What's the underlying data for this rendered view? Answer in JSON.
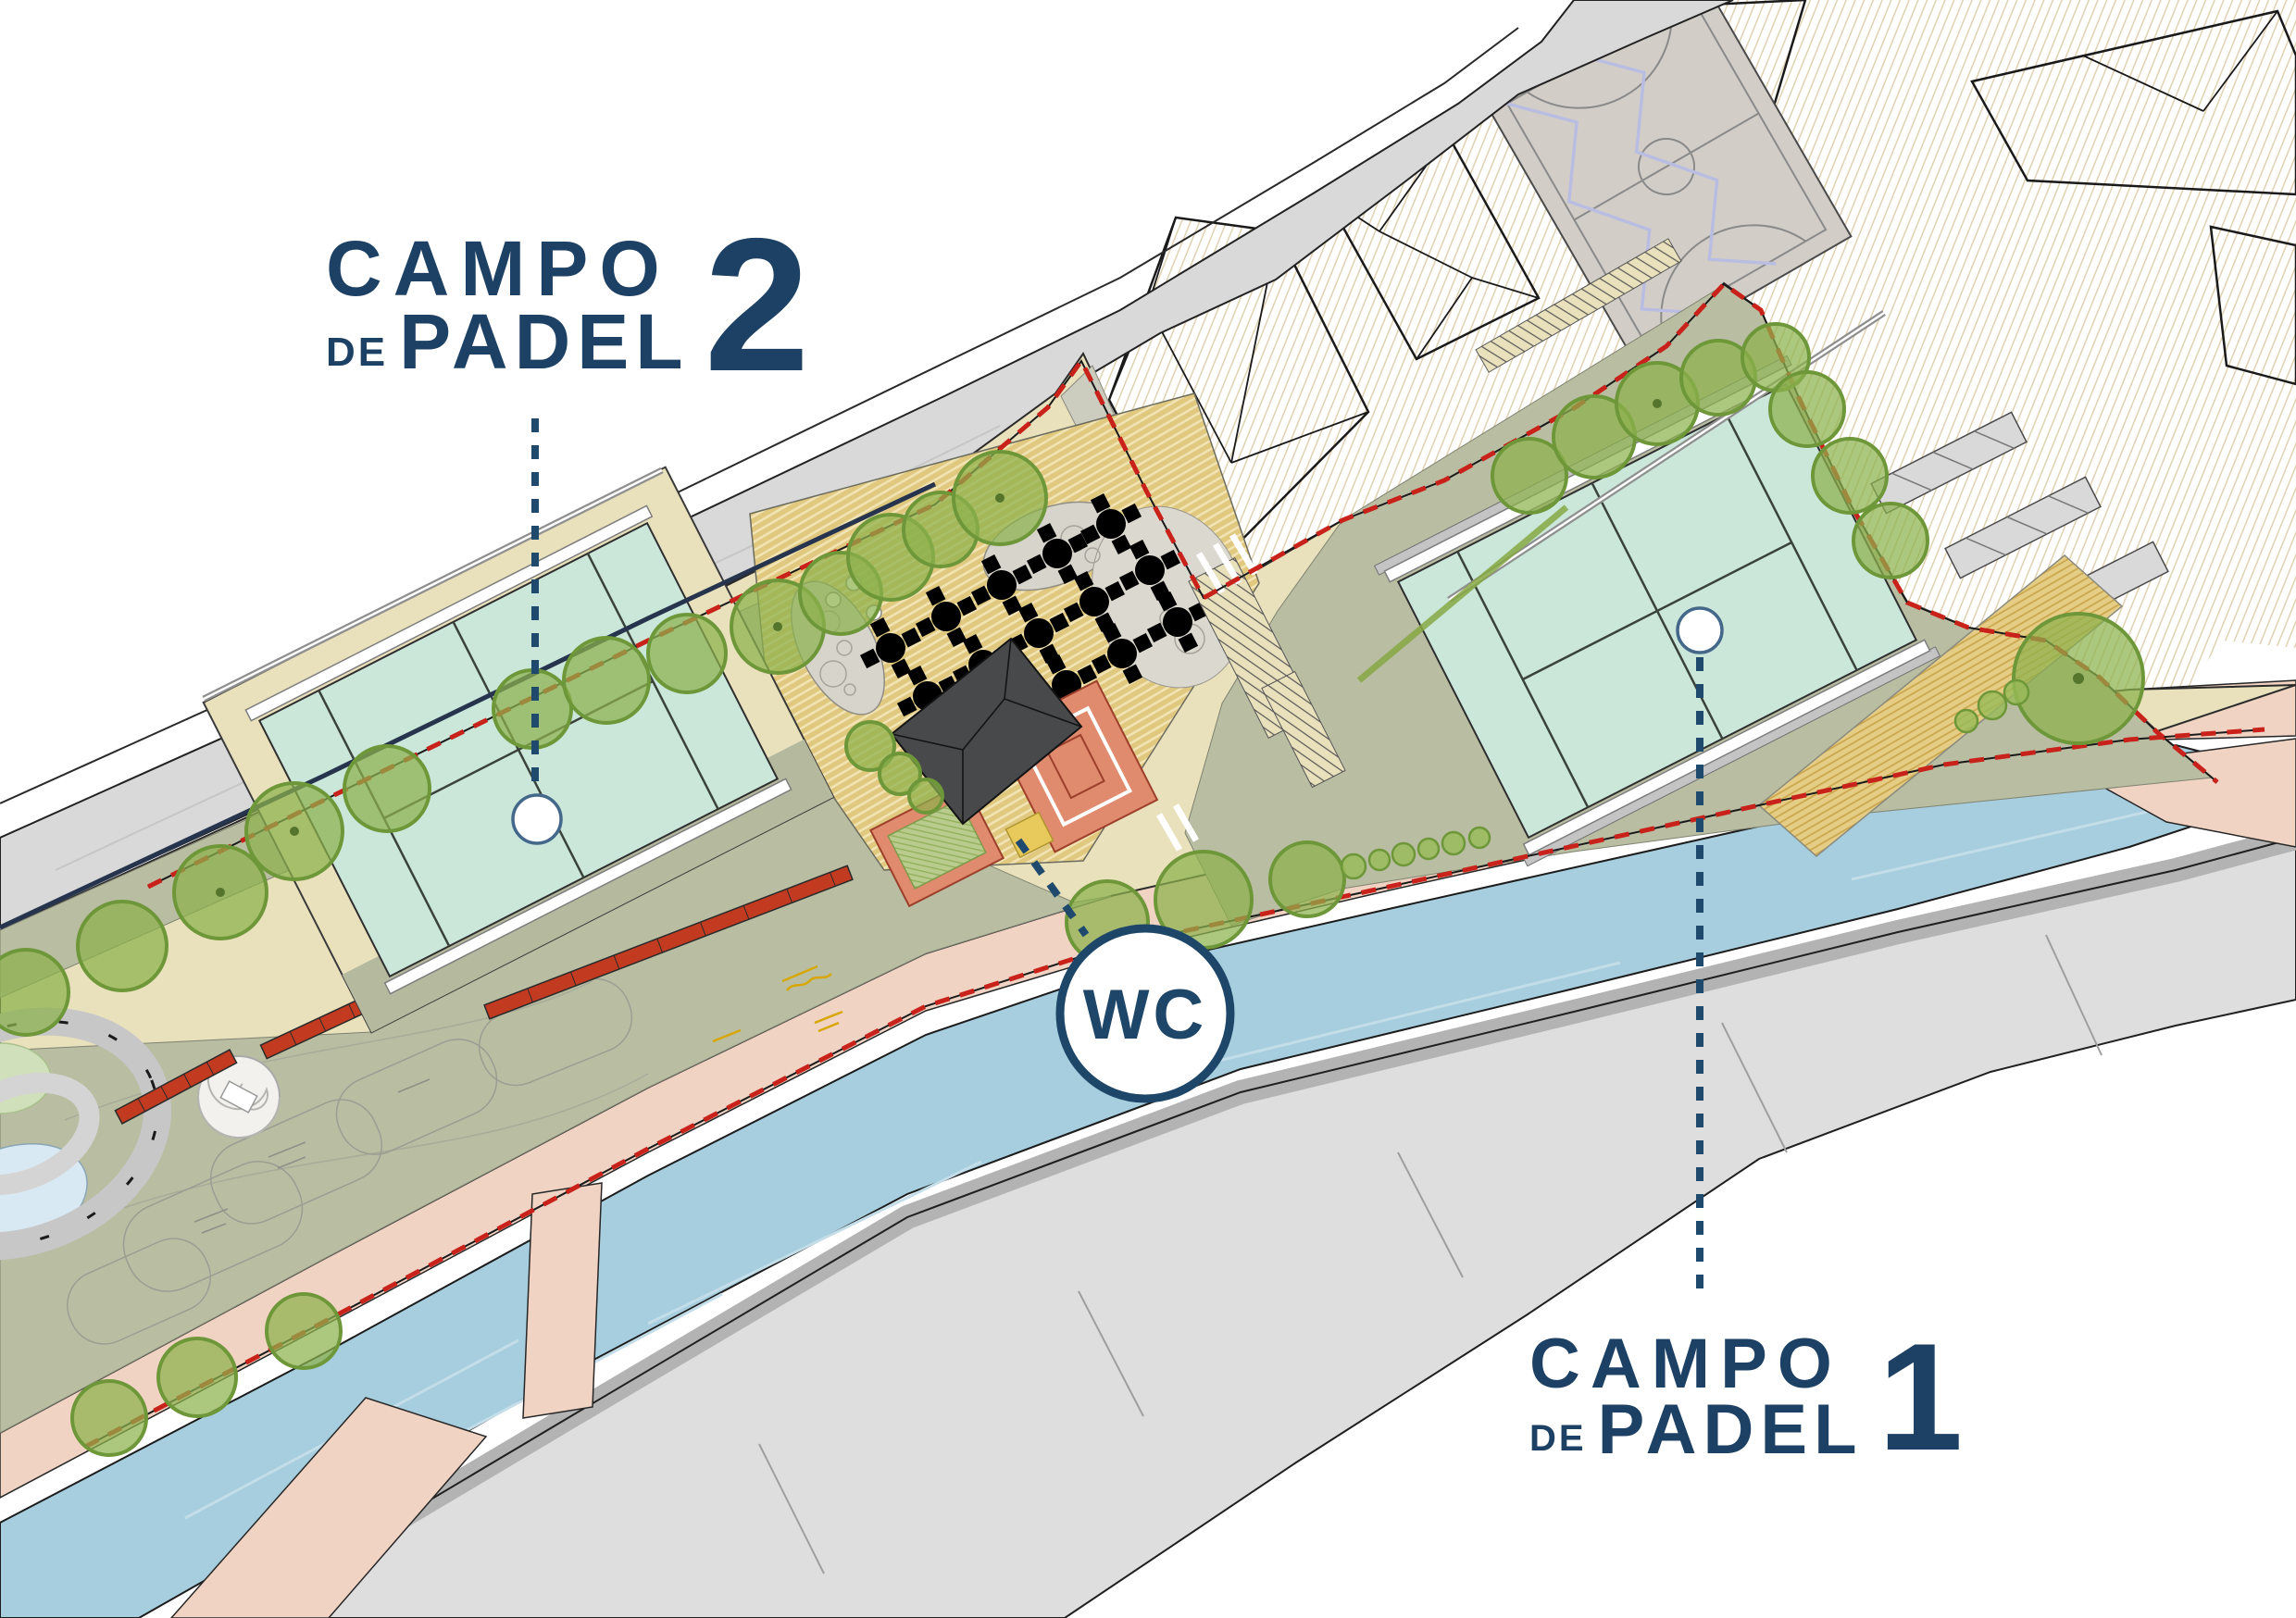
{
  "title_labels": {
    "campo2": {
      "line1": "CAMPO",
      "de": "DE",
      "line2": "PADEL",
      "number": "2"
    },
    "campo1": {
      "line1": "CAMPO",
      "de": "DE",
      "line2": "PADEL",
      "number": "1"
    }
  },
  "wc_badge": {
    "label": "WC"
  },
  "colors": {
    "label_navy": "#1d4164",
    "leader_navy": "#1f4a6e",
    "court_mint": "#cbe7da",
    "river_blue": "#a7cede",
    "path_beige": "#e9e0bc",
    "lawn_olive": "#b9bda2",
    "promenade_pink": "#f0d3c3",
    "road_grey": "#d9d9d9",
    "tree_green": "#8cb14c",
    "boundary_red_dash": "#c8221a",
    "terrace_salmon": "#e08a6e",
    "deck_tan": "#e0c87f",
    "kiosk_roof_grey": "#47494b",
    "bench_red": "#c23a1f"
  }
}
